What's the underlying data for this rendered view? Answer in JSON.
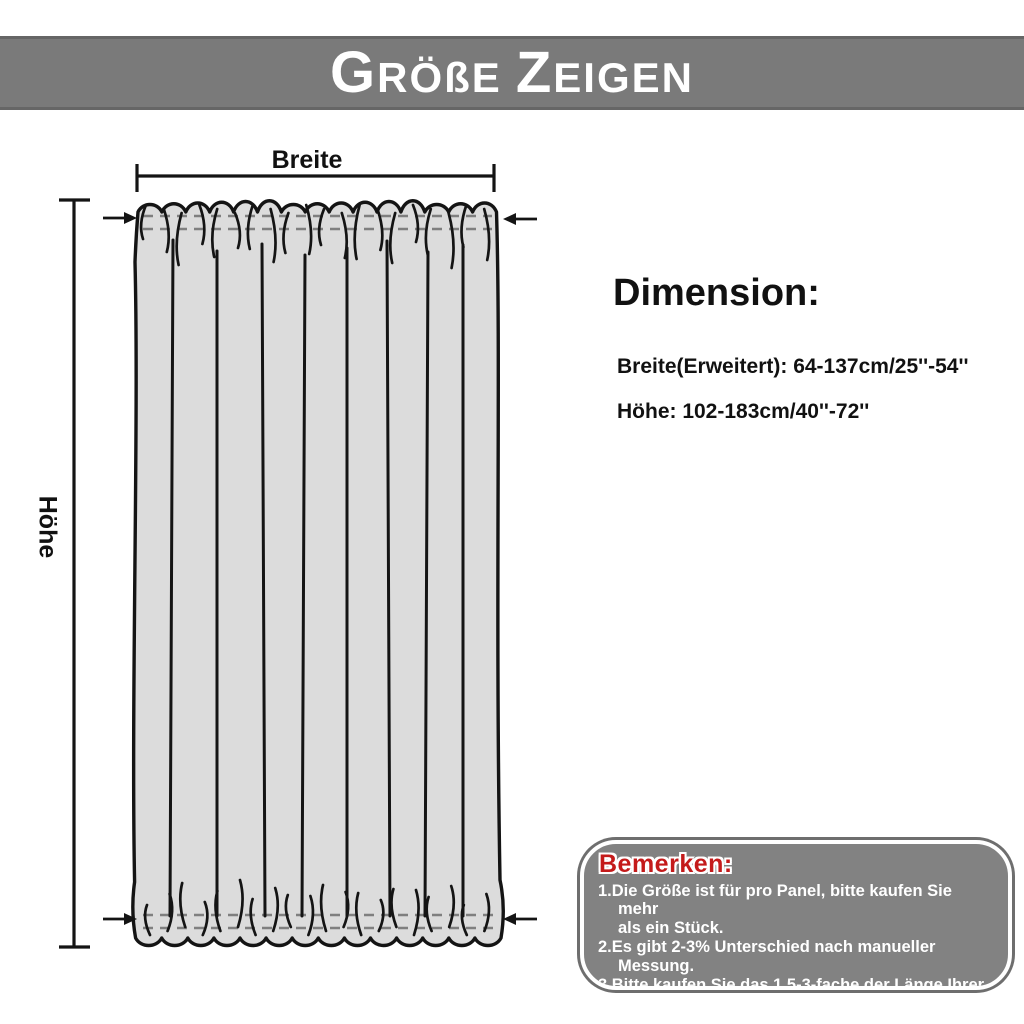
{
  "header": {
    "title": "GRÖßE ZEIGEN",
    "title_parts": {
      "initial1": "G",
      "rest1": "RÖßE",
      "initial2": "Z",
      "rest2": "EIGEN"
    },
    "bg_color": "#7a7a7a",
    "text_color": "#ffffff"
  },
  "diagram": {
    "width_label": "Breite",
    "height_label": "Höhe",
    "curtain_fill": "#dcdcdc",
    "line_color": "#141414"
  },
  "dimensions": {
    "heading": "Dimension:",
    "width_spec": "Breite(Erweitert): 64-137cm/25''-54''",
    "height_spec": "Höhe: 102-183cm/40''-72''"
  },
  "notes": {
    "heading": "Bemerken:",
    "heading_color": "#c41a1a",
    "box_color": "#828282",
    "items": [
      {
        "text": "1.Die Größe ist für pro Panel, bitte kaufen Sie mehr\nals ein Stück."
      },
      {
        "text": "2.Es gibt 2-3% Unterschied nach manueller\nMessung."
      },
      {
        "text": "3.Bitte kaufen Sie das 1,5-3-fache der Länge Ihrer\nRute."
      }
    ]
  }
}
